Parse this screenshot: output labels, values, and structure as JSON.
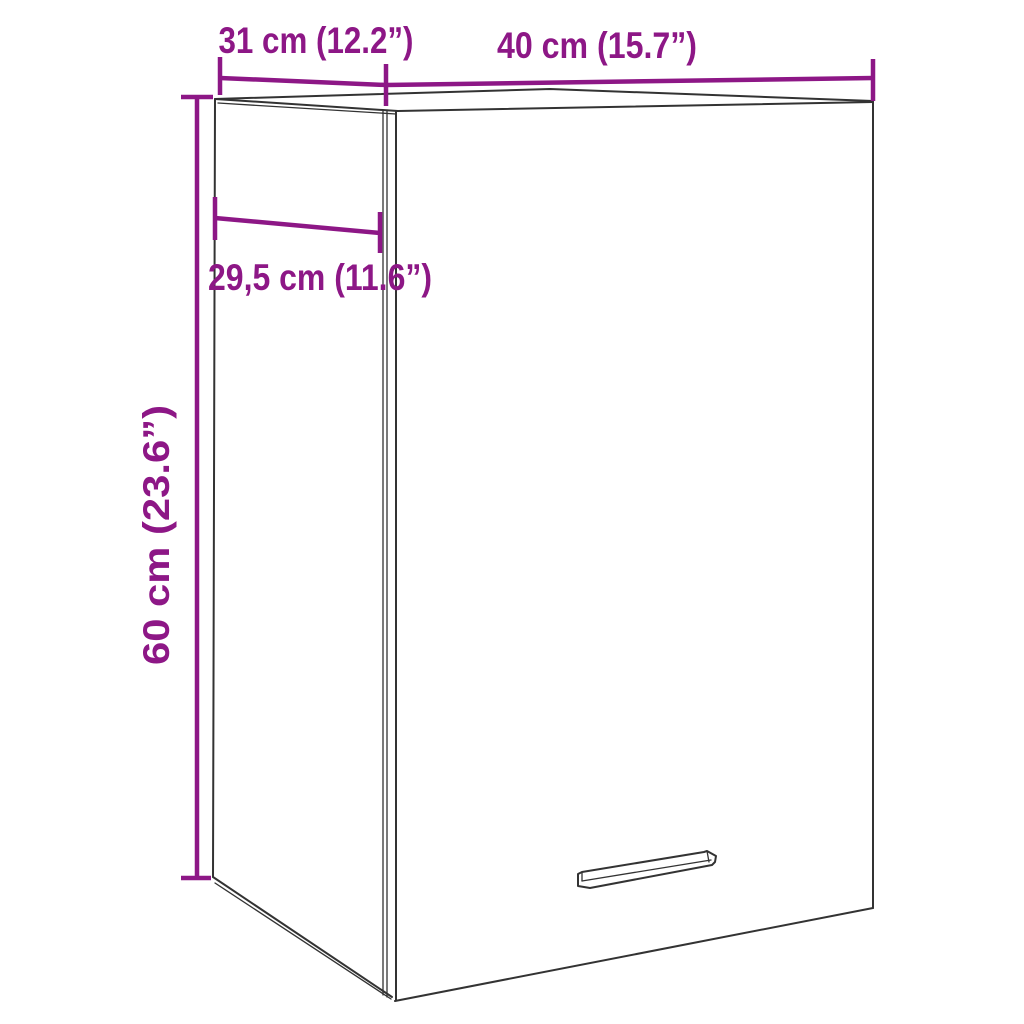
{
  "diagram": {
    "kind": "product-dimension-diagram",
    "subject": "wall-cabinet-line-drawing"
  },
  "colors": {
    "dimension_accent": "#8D1786",
    "outline": "#333333",
    "background": "#FFFFFF"
  },
  "dims": {
    "top_depth": {
      "label": "31 cm (12.2”)",
      "cm": "31",
      "inches": "12.2"
    },
    "top_width": {
      "label": "40 cm (15.7”)",
      "cm": "40",
      "inches": "15.7"
    },
    "side_depth": {
      "label": "29,5 cm (11.6”)",
      "cm": "29,5",
      "inches": "11.6"
    },
    "height": {
      "label": "60 cm (23.6”)",
      "cm": "60",
      "inches": "23.6"
    }
  }
}
